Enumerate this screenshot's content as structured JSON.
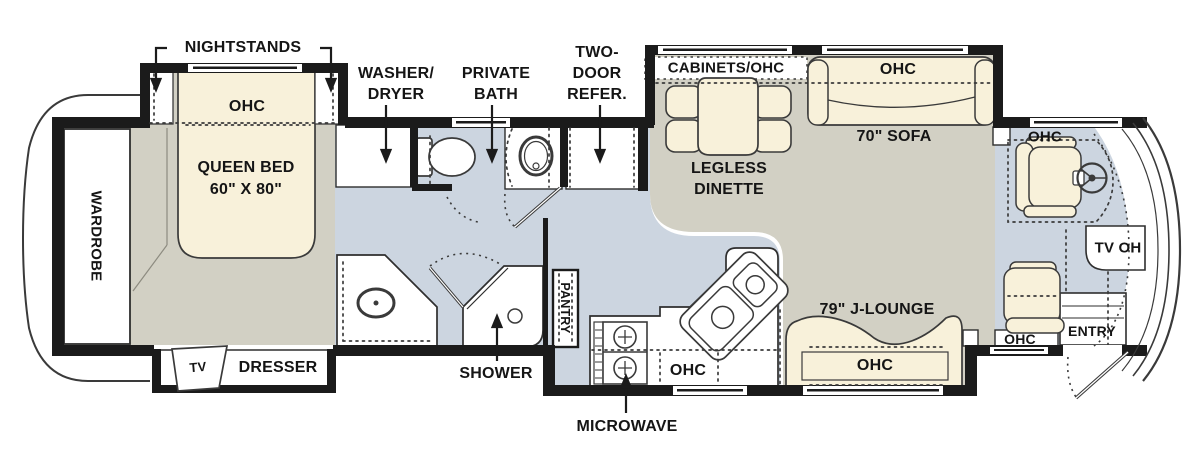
{
  "title": "Motorhome floor plan",
  "colors": {
    "wall_black": "#1b1b1b",
    "floor_gray": "#d2d0c4",
    "floor_blue": "#ccd5e0",
    "furniture_cream": "#f8f1da",
    "fixture_white": "#ffffff",
    "outline": "#333333"
  },
  "fp": {
    "bedroom": {
      "nightstands": "NIGHTSTANDS",
      "ohc": "OHC",
      "bed_line1": "QUEEN BED",
      "bed_line2": "60\" X 80\"",
      "wardrobe": "WARDROBE",
      "tv": "TV",
      "dresser": "DRESSER"
    },
    "bath": {
      "washer_dryer1": "WASHER/",
      "washer_dryer2": "DRYER",
      "private1": "PRIVATE",
      "private2": "BATH",
      "shower": "SHOWER",
      "pantry": "PANTRY"
    },
    "kitchen": {
      "refer1": "TWO-",
      "refer2": "DOOR",
      "refer3": "REFER.",
      "microwave": "MICROWAVE",
      "ohc": "OHC"
    },
    "living": {
      "cabinets": "CABINETS/OHC",
      "sofa_ohc": "OHC",
      "sofa": "70\" SOFA",
      "dinette1": "LEGLESS",
      "dinette2": "DINETTE",
      "jlounge": "79\" J-LOUNGE",
      "jlounge_ohc": "OHC"
    },
    "cockpit": {
      "ohc": "OHC",
      "tv_oh": "TV OH",
      "passenger_ohc": "OHC",
      "entry": "ENTRY"
    }
  }
}
